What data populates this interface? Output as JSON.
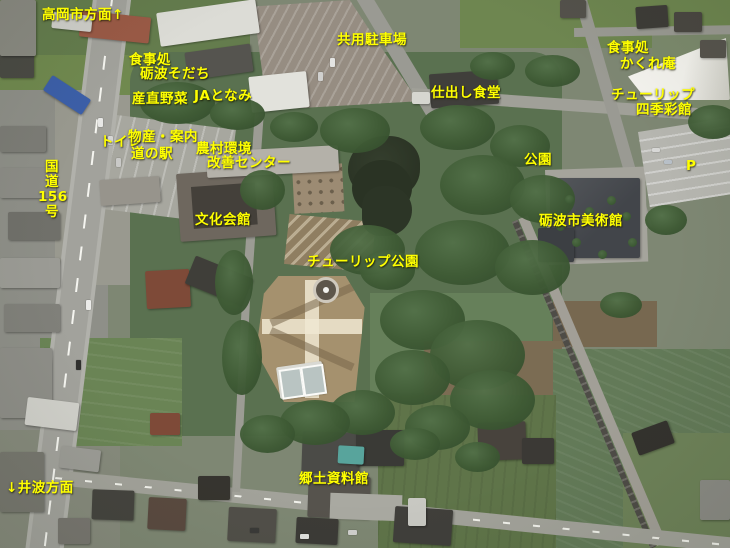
{
  "colors": {
    "label": "#ffff00",
    "road": "#a2a29c",
    "water": "#2c3526",
    "trees": "#3e5a34",
    "tulip_field": "#a5916e",
    "farm_brown": "#7b6c53"
  },
  "labels": [
    {
      "id": "takaoka-direction",
      "text": "高岡市方面↑",
      "x": 42,
      "y": 8
    },
    {
      "id": "restaurant-tonamisodachi-line1",
      "text": "食事処",
      "x": 129,
      "y": 53
    },
    {
      "id": "restaurant-tonamisodachi-line2",
      "text": "砺波そだち",
      "x": 140,
      "y": 67
    },
    {
      "id": "sanchoku-yasai",
      "text": "産直野菜",
      "x": 132,
      "y": 92
    },
    {
      "id": "ja-tonami",
      "text": "JAとなみ",
      "x": 194,
      "y": 89
    },
    {
      "id": "shared-parking",
      "text": "共用駐車場",
      "x": 337,
      "y": 33
    },
    {
      "id": "shidashi-shokudo",
      "text": "仕出し食堂",
      "x": 431,
      "y": 86
    },
    {
      "id": "restaurant-kakurean-line1",
      "text": "食事処",
      "x": 607,
      "y": 41
    },
    {
      "id": "restaurant-kakurean-line2",
      "text": "かくれ庵",
      "x": 620,
      "y": 57
    },
    {
      "id": "tulip-shikisaikan-line1",
      "text": "チューリップ",
      "x": 611,
      "y": 88
    },
    {
      "id": "tulip-shikisaikan-line2",
      "text": "四季彩館",
      "x": 636,
      "y": 103
    },
    {
      "id": "toilet",
      "text": "トイレ",
      "x": 100,
      "y": 135
    },
    {
      "id": "bussan-annai",
      "text": "物産・案内",
      "x": 128,
      "y": 130
    },
    {
      "id": "michi-no-eki",
      "text": "道の駅",
      "x": 131,
      "y": 147
    },
    {
      "id": "noson-kankyo",
      "text": "農村環境",
      "x": 196,
      "y": 142
    },
    {
      "id": "kaizen-center",
      "text": "改善センター",
      "x": 207,
      "y": 156
    },
    {
      "id": "park-label",
      "text": "公園",
      "x": 524,
      "y": 153
    },
    {
      "id": "parking-p",
      "text": "P",
      "x": 686,
      "y": 159
    },
    {
      "id": "national-route-156",
      "lines": [
        "国",
        "道",
        "156",
        "号"
      ],
      "vertical": true,
      "x": 38,
      "y": 160
    },
    {
      "id": "bunka-kaikan",
      "text": "文化会館",
      "x": 195,
      "y": 213
    },
    {
      "id": "tonami-art-museum",
      "text": "砺波市美術館",
      "x": 539,
      "y": 214
    },
    {
      "id": "tulip-park",
      "text": "チューリップ公園",
      "x": 307,
      "y": 255
    },
    {
      "id": "kyodo-shiryokan",
      "text": "郷土資料館",
      "x": 299,
      "y": 472
    },
    {
      "id": "inami-direction",
      "text": "↓井波方面",
      "x": 6,
      "y": 481
    }
  ]
}
